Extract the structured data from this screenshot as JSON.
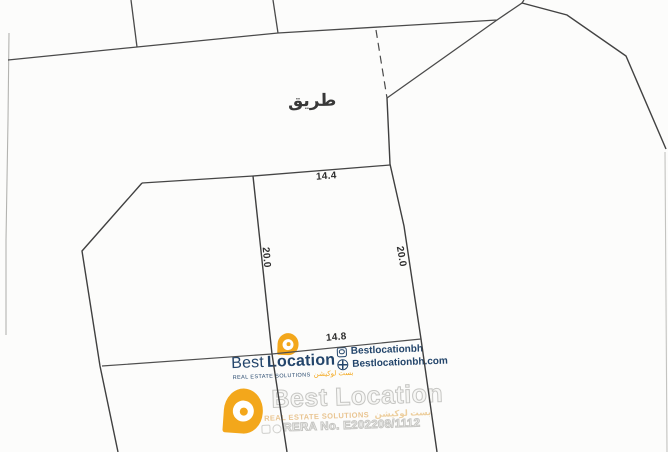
{
  "map": {
    "road_label": "طريق",
    "dim_top": "14.4",
    "dim_bottom": "14.8",
    "dim_left": "20.0",
    "dim_right": "20.0"
  },
  "brand": {
    "name_first": "Best",
    "name_second": "Location",
    "tagline_en": "REAL ESTATE SOLUTIONS",
    "tagline_ar": "بست لوكيشن",
    "instagram": "Bestlocationbh",
    "website": "Bestlocationbh.com",
    "rera": "RERA No. E202208/1112",
    "colors": {
      "navy": "#23456b",
      "orange": "#f3a71b"
    }
  }
}
